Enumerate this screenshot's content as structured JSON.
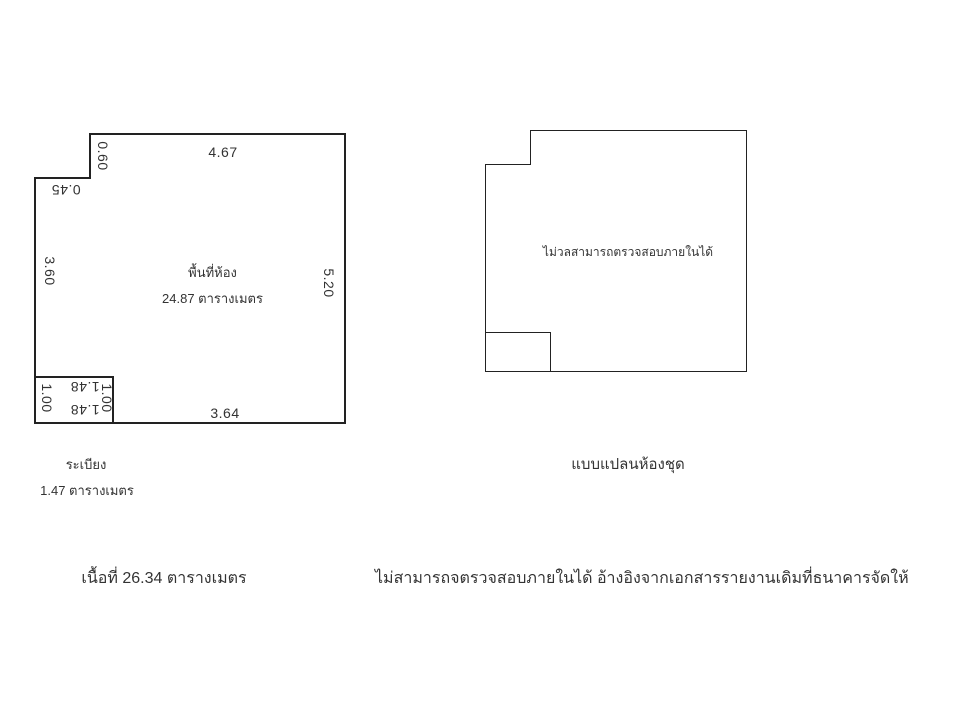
{
  "left_plan": {
    "room_label_line1": "พื้นที่ห้อง",
    "room_label_line2": "24.87 ตารางเมตร",
    "dimensions": {
      "top": "4.67",
      "notch_height": "0.60",
      "notch_width": "0.45",
      "left": "3.60",
      "right": "5.20",
      "bottom": "3.64",
      "balcony_top": "1.48",
      "balcony_bottom": "1.48",
      "balcony_left": "1.00",
      "balcony_right": "1.00"
    },
    "balcony_caption_line1": "ระเบียง",
    "balcony_caption_line2": "1.47 ตารางเมตร"
  },
  "right_plan": {
    "center_note": "ไม่วลสามารถตรวจสอบภายในได้",
    "caption": "แบบแปลนห้องชุด"
  },
  "footer": {
    "total_area": "เนื้อที่ 26.34 ตารางเมตร",
    "note": "ไม่สามารถจตรวจสอบภายในได้ อ้างอิงจากเอกสารรายงานเดิมที่ธนาคารจัดให้"
  },
  "colors": {
    "line": "#222222",
    "text": "#333333",
    "background": "#ffffff"
  }
}
